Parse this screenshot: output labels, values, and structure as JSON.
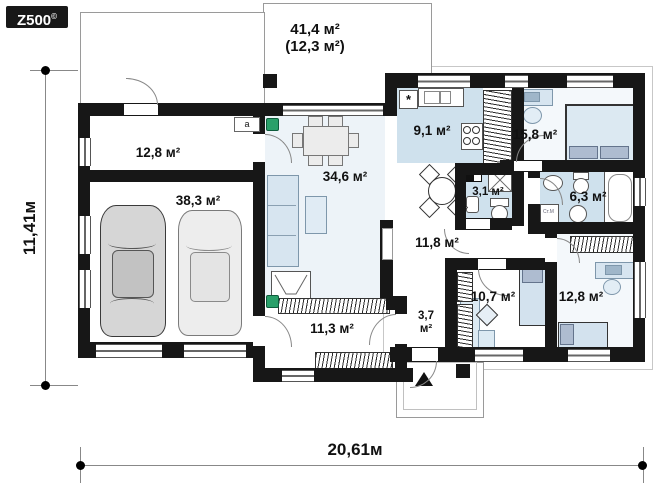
{
  "logo": {
    "text": "Z500",
    "sup": "©"
  },
  "dimensions": {
    "width": "20,61м",
    "height": "11,41м"
  },
  "rooms": {
    "terrace": {
      "area": "41,4 м²",
      "area_secondary": "(12,3 м²)"
    },
    "utility": {
      "area": "12,8 м²"
    },
    "garage": {
      "area": "38,3 м²"
    },
    "living": {
      "area": "34,6 м²"
    },
    "kitchen": {
      "area": "9,1 м²"
    },
    "bedroom_main": {
      "area": "15,8 м²"
    },
    "wc": {
      "area": "3,1 м²"
    },
    "bathroom": {
      "area": "6,3 м²"
    },
    "hall": {
      "area": "11,8 м²"
    },
    "bedroom_left": {
      "area": "10,7 м²"
    },
    "bedroom_right": {
      "area": "12,8 м²"
    },
    "wardrobe": {
      "area": "11,3 м²"
    },
    "vestibule": {
      "line1": "3,7",
      "line2": "м²"
    }
  },
  "symbols": {
    "fridge": "*",
    "boiler": "а",
    "washer": "Ст.М"
  },
  "colors": {
    "wall": "#171717",
    "wet_room_fill": "#cfe1ed",
    "living_fill": "#edf3f8",
    "bedroom_fill": "#f4f8fb",
    "furniture_fill": "#d7e5f0",
    "car_grey": "#d6d6d6",
    "marker_green": "#2aa06a"
  }
}
